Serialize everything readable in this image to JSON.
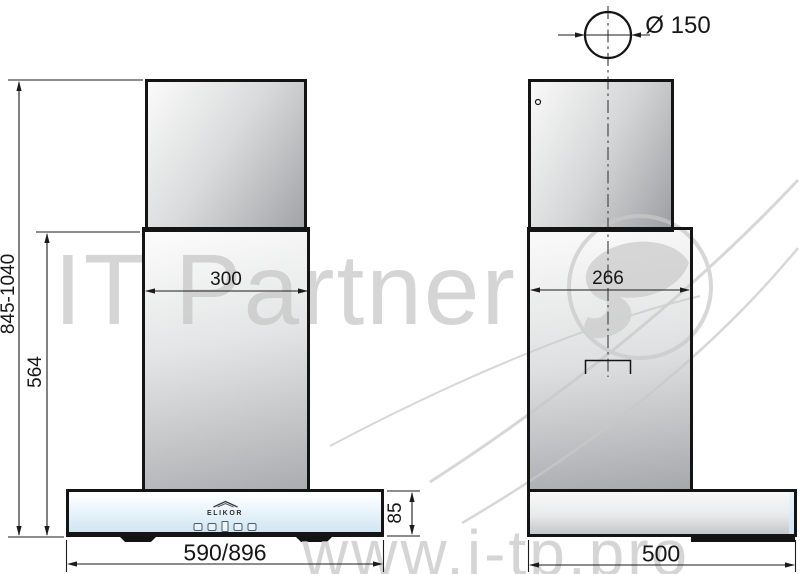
{
  "front_view": {
    "dims": {
      "total_height": "845-1040",
      "body_height": "564",
      "chimney_width": "300",
      "hood_width": "590/896",
      "hood_height": "85"
    }
  },
  "side_view": {
    "dims": {
      "duct_diameter": "Ø 150",
      "chimney_depth": "266",
      "hood_depth": "500"
    }
  },
  "brand": {
    "logo_text": "ELIKOR"
  },
  "watermarks": {
    "name_text": "IT Partner",
    "site_text": "www.i-tp.pro"
  },
  "icons": {
    "roof": "elikor-roof-icon",
    "controls": [
      "control-button-1",
      "control-button-2",
      "control-display",
      "control-button-3",
      "control-button-4"
    ]
  },
  "colors": {
    "glass_blue": "#cfe4f2",
    "metal_light": "#fbfbfb",
    "metal_dark": "#9fa2a5",
    "outline": "#141414",
    "dimension_line": "#1b1b1b",
    "watermark_gray": "#c6c6c6"
  }
}
